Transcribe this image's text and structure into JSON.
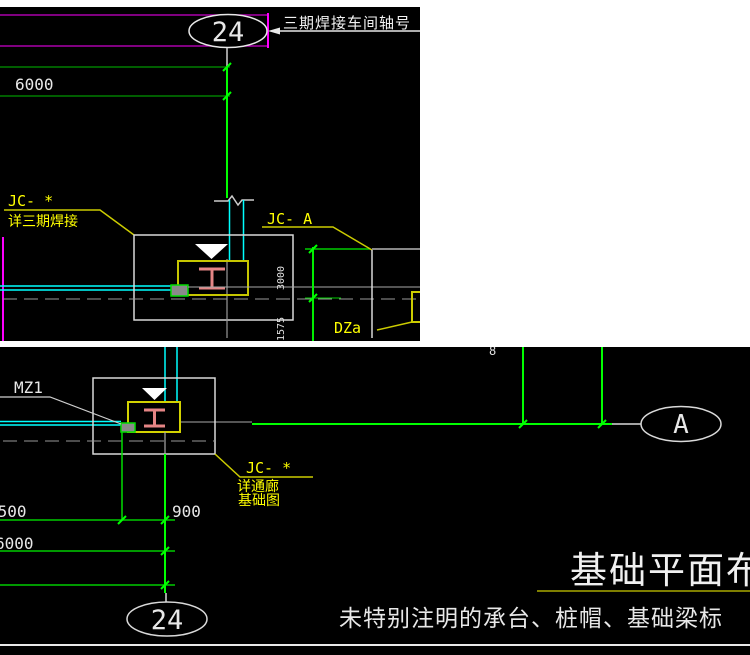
{
  "colors": {
    "background": "#000000",
    "page": "#ffffff",
    "axis_green_bright": "#00ff00",
    "axis_green_dim": "#007d00",
    "dim_green": "#00cc00",
    "cyan": "#00ffff",
    "magenta_bright": "#ff00ff",
    "magenta_dim": "#aa00aa",
    "yellow_text": "#ffff00",
    "yellow_line": "#cccc00",
    "beam_red": "#e58585",
    "white_line": "#d9d9d9",
    "gray_line": "#9a9a9a"
  },
  "top": {
    "bubble": "24",
    "axis_note": "三期焊接车间轴号",
    "dim_span": "6000",
    "jc_label": "JC- *",
    "jc_sub": "详三期焊接",
    "jc_a_label": "JC- A",
    "dza_label": "DZa",
    "dim_rot_upper": "3000",
    "dim_rot_lower": "1575"
  },
  "bottom": {
    "mz1_label": "MZ1",
    "partial_dim_digit": "8",
    "axis_a_bubble": "A",
    "axis_24_bubble": "24",
    "jc_label": "JC- *",
    "jc_sub_line1": "详通廊",
    "jc_sub_line2": "基础图",
    "dim_1500": "1500",
    "dim_900": "900",
    "dim_6000": "6000",
    "title": "基础平面布",
    "note": "未特别注明的承台、桩帽、基础梁标"
  }
}
